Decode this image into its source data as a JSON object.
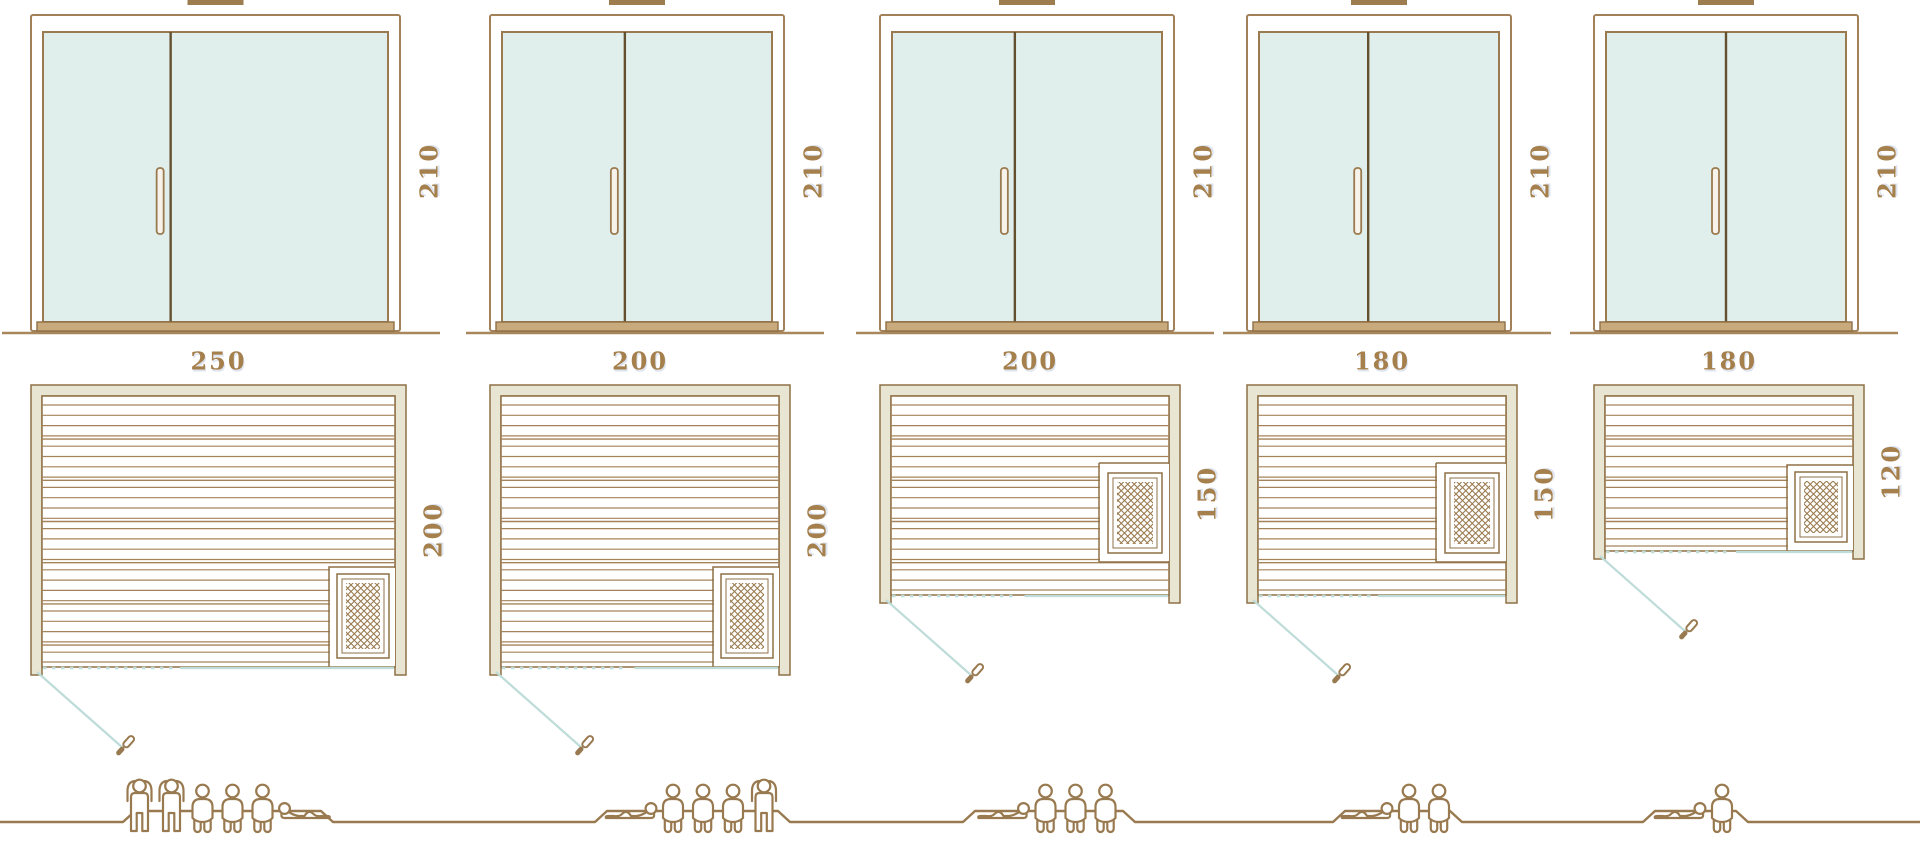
{
  "units": [
    {
      "width_label": "250",
      "depth_label": "200",
      "door_height_label": "210",
      "capacity": 6,
      "heater_position": "front-right-corner",
      "people": [
        "standing",
        "standing",
        "sitting",
        "sitting",
        "sitting",
        "lying"
      ]
    },
    {
      "width_label": "200",
      "depth_label": "200",
      "door_height_label": "210",
      "capacity": 5,
      "heater_position": "front-right-corner",
      "people": [
        "lying",
        "sitting",
        "sitting",
        "sitting",
        "standing"
      ]
    },
    {
      "width_label": "200",
      "depth_label": "150",
      "door_height_label": "210",
      "capacity": 4,
      "heater_position": "right-wall-middle",
      "people": [
        "lying",
        "sitting",
        "sitting",
        "sitting"
      ]
    },
    {
      "width_label": "180",
      "depth_label": "150",
      "door_height_label": "210",
      "capacity": 3,
      "heater_position": "right-wall-middle",
      "people": [
        "lying",
        "sitting",
        "sitting"
      ]
    },
    {
      "width_label": "180",
      "depth_label": "120",
      "door_height_label": "210",
      "capacity": 2,
      "heater_position": "front-right-corner",
      "people": [
        "lying",
        "sitting"
      ]
    }
  ],
  "icons": {
    "roof_vent": "roof-vent-icon",
    "door_handle": "door-handle-icon",
    "door_swing": "door-swing-line-icon",
    "heater": "sauna-heater-crosshatch-icon",
    "person_standing": "person-standing-icon",
    "person_sitting": "person-sitting-icon",
    "person_lying": "person-lying-icon"
  },
  "colors": {
    "outline_brown": "#8e7046",
    "wood_line": "#a5835a",
    "frame_brown": "#a28059",
    "divider_dark": "#64502f",
    "glass_fill": "#e0efec",
    "wall_fill": "#e8e6d3",
    "sill_fill": "#c9aa7c",
    "vent_fill": "#9d7c50",
    "accent_blue": "#bedcd8",
    "label_text": "#a5804d",
    "people_outline": "#997a50"
  }
}
